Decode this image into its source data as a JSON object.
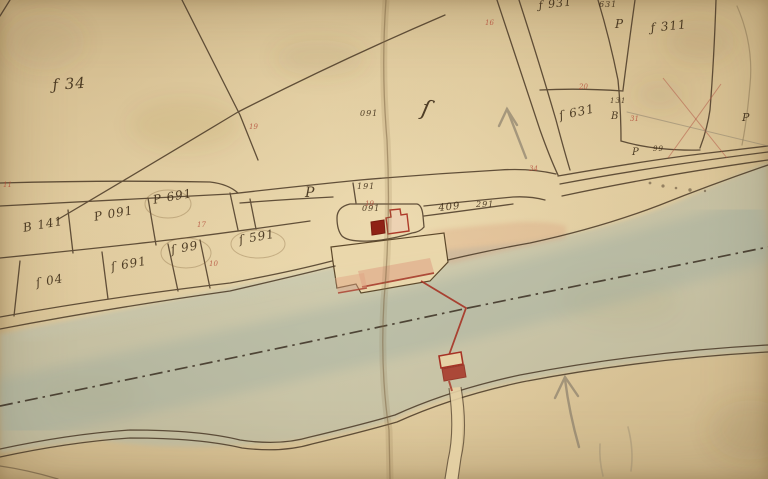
{
  "map": {
    "type_note": "hand-drawn cadastral plan with river, quay, ferry alignment",
    "colors": {
      "paper": "#e4cfa2",
      "ink": "#4a3926",
      "red_accent": "#a63325",
      "building_fill": "#8f2216",
      "river_wash": "#a8b7ae",
      "pink_wash": "#dfa183",
      "pencil": "#7d7464",
      "axis_line": "#33271a"
    }
  },
  "labels": {
    "ink": [
      {
        "text": "ƒ 34"
      },
      {
        "text": "B 141"
      },
      {
        "text": "P 091"
      },
      {
        "text": "P 691"
      },
      {
        "text": "ſ 04"
      },
      {
        "text": "ſ 691"
      },
      {
        "text": "ſ 99"
      },
      {
        "text": "ſ 591"
      },
      {
        "text": "P"
      },
      {
        "text": "191"
      },
      {
        "text": "091"
      },
      {
        "text": "ſ"
      },
      {
        "text": "091"
      },
      {
        "text": "409"
      },
      {
        "text": "291"
      },
      {
        "text": "ƒ 931"
      },
      {
        "text": "631"
      },
      {
        "text": "P"
      },
      {
        "text": "ƒ 311"
      },
      {
        "text": "ſ 631"
      },
      {
        "text": "131"
      },
      {
        "text": "B"
      },
      {
        "text": "P"
      },
      {
        "text": "99"
      },
      {
        "text": "P"
      }
    ],
    "red": [
      {
        "text": "16"
      },
      {
        "text": "34"
      },
      {
        "text": "19"
      },
      {
        "text": "11"
      },
      {
        "text": "17"
      },
      {
        "text": "10"
      },
      {
        "text": "19"
      },
      {
        "text": "20"
      },
      {
        "text": "31"
      }
    ]
  }
}
